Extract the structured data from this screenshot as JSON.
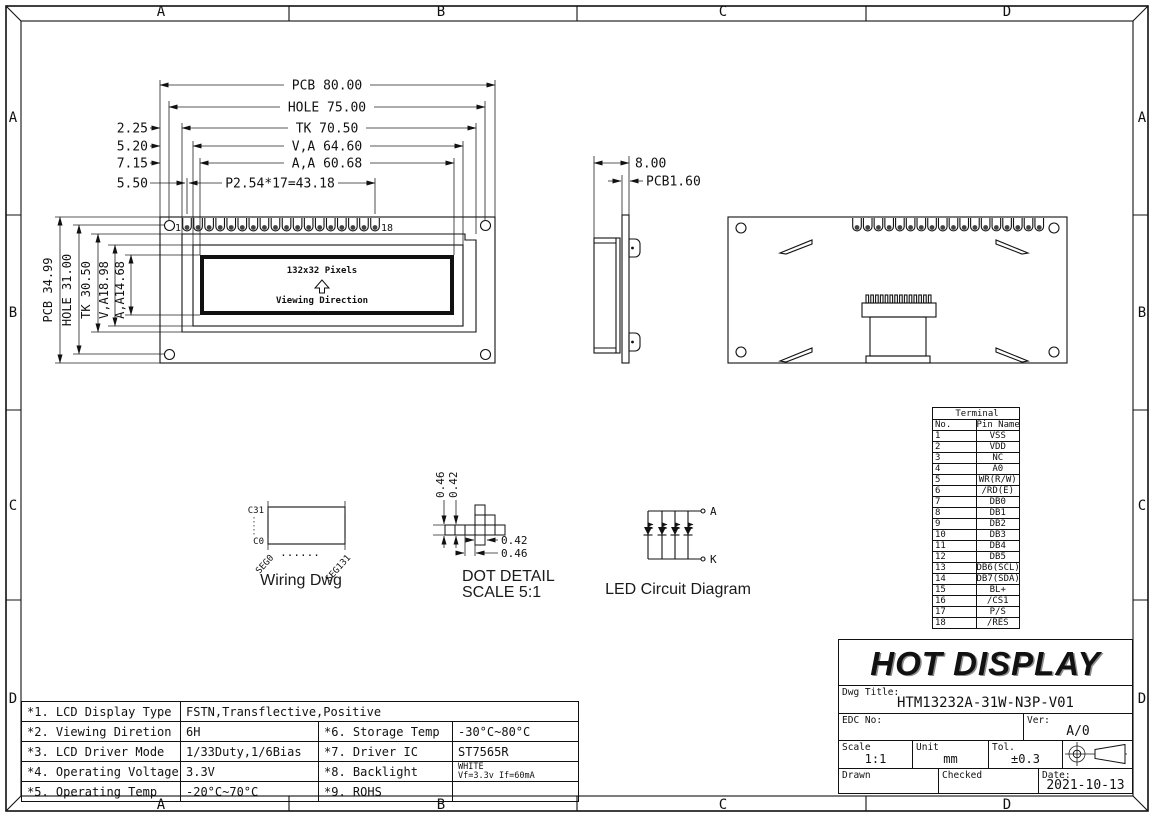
{
  "frame": {
    "cols": [
      "A",
      "B",
      "C",
      "D"
    ],
    "rows": [
      "A",
      "B",
      "C",
      "D"
    ]
  },
  "front_view": {
    "h_dims": [
      "PCB  80.00",
      "HOLE  75.00",
      "TK  70.50",
      "V,A  64.60",
      "A,A  60.68",
      "P2.54*17=43.18"
    ],
    "h_offsets": [
      "2.25",
      "5.20",
      "7.15",
      "5.50"
    ],
    "v_dims": [
      "PCB 34.99",
      "HOLE 31.00",
      "TK 30.50",
      "V,A18.98",
      "A,A14.68"
    ],
    "pin_first": "1",
    "pin_last": "18",
    "display_label": "132x32 Pixels",
    "viewing_label": "Viewing Direction"
  },
  "side_view": {
    "dim_width": "8.00",
    "dim_pcb": "PCB1.60"
  },
  "wiring_dwg": {
    "top_label": "C31",
    "bottom_label": "C0",
    "seg_first": "SEG0",
    "seg_last": "SEG131",
    "dots": "......",
    "caption": "Wiring Dwg"
  },
  "dot_detail": {
    "left_outer": "0.46",
    "left_inner": "0.42",
    "bottom_inner": "0.42",
    "bottom_outer": "0.46",
    "caption": "DOT DETAIL",
    "scale": "SCALE 5:1"
  },
  "led_circuit": {
    "anode": "A",
    "cathode": "K",
    "caption": "LED Circuit  Diagram"
  },
  "terminal_table": {
    "title": "Terminal",
    "col_no": "No.",
    "col_name": "Pin Name",
    "rows": [
      [
        "1",
        "VSS"
      ],
      [
        "2",
        "VDD"
      ],
      [
        "3",
        "NC"
      ],
      [
        "4",
        "A0"
      ],
      [
        "5",
        "WR(R/W)"
      ],
      [
        "6",
        "/RD(E)"
      ],
      [
        "7",
        "DB0"
      ],
      [
        "8",
        "DB1"
      ],
      [
        "9",
        "DB2"
      ],
      [
        "10",
        "DB3"
      ],
      [
        "11",
        "DB4"
      ],
      [
        "12",
        "DB5"
      ],
      [
        "13",
        "DB6(SCL)"
      ],
      [
        "14",
        "DB7(SDA)"
      ],
      [
        "15",
        "BL+"
      ],
      [
        "16",
        "/CS1"
      ],
      [
        "17",
        "P/S"
      ],
      [
        "18",
        "/RES"
      ]
    ]
  },
  "spec_table": {
    "r1_label": "*1. LCD Display Type",
    "r1_value": "FSTN,Transflective,Positive",
    "r2_label": "*2. Viewing Diretion",
    "r2_value": "6H",
    "r3_label": "*3. LCD Driver Mode",
    "r3_value": "1/33Duty,1/6Bias",
    "r4_label": "*4. Operating Voltage",
    "r4_value": "3.3V",
    "r5_label": "*5. Operating Temp",
    "r5_value": "-20°C~70°C",
    "r6_label": "*6. Storage Temp",
    "r6_value": "-30°C~80°C",
    "r7_label": "*7. Driver IC",
    "r7_value": "ST7565R",
    "r8_label": "*8. Backlight",
    "r8_value_line1": "WHITE",
    "r8_value_line2": "Vf=3.3v If=60mA",
    "r9_label": "*9. ROHS",
    "r9_value": ""
  },
  "title_block": {
    "company": "HOT DISPLAY",
    "dwg_title_label": "Dwg Title:",
    "dwg_title": "HTM13232A-31W-N3P-V01",
    "edc_label": "EDC No:",
    "ver_label": "Ver:",
    "ver": "A/0",
    "scale_label": "Scale",
    "scale": "1:1",
    "unit_label": "Unit",
    "unit": "mm",
    "tol_label": "Tol.",
    "tol": "±0.3",
    "drawn_label": "Drawn",
    "checked_label": "Checked",
    "date_label": "Date:",
    "date": "2021-10-13"
  }
}
